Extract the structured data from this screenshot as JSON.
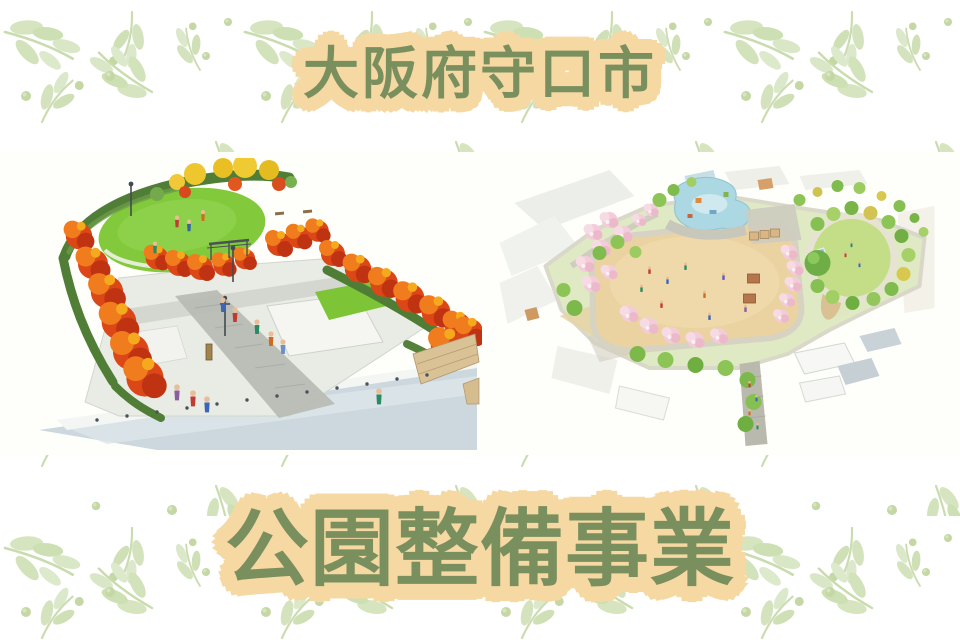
{
  "theme": {
    "accent-green": "#7a8f5e",
    "highlight-peach": "#f6d8a2",
    "band-white": "#fefefb",
    "pattern-leaf": "#d6e4c0"
  },
  "header": {
    "title": "大阪府守口市"
  },
  "footer": {
    "title": "公園整備事業"
  },
  "gallery": {
    "images": [
      {
        "name": "autumn-park-perspective-rendering",
        "label": "autumn park perspective rendering"
      },
      {
        "name": "aerial-park-plan-rendering",
        "label": "aerial park plan rendering"
      }
    ]
  }
}
